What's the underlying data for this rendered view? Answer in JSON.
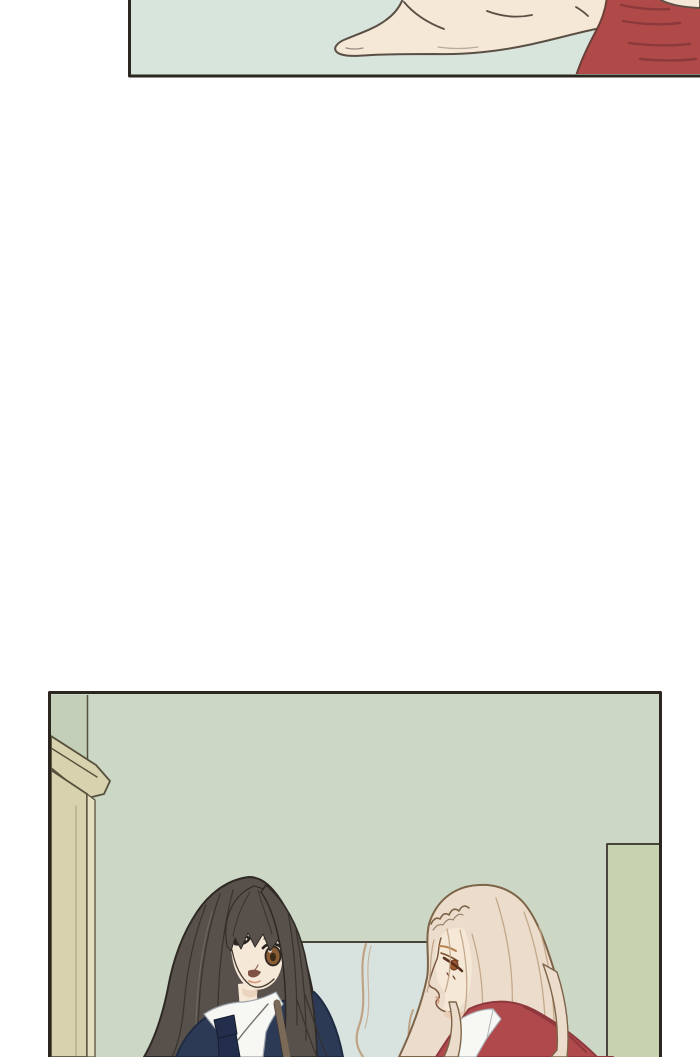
{
  "page": {
    "title": "webtoon comic page",
    "background": "#ffffff",
    "text_content": "none - image-only comic panels"
  },
  "colors": {
    "pageBg": "#ffffff",
    "panelBorder": "#2c2621",
    "mint": "#d8e5dc",
    "skin": "#f5e8d7",
    "outline": "#5a4f44",
    "sleeveRed": "#b04a49",
    "sleeveStroke": "#8c393b",
    "sleeveEdge": "#6b4038",
    "wallGreen": "#ccd8c5",
    "wallStrip": "#c3cfb8",
    "doorKhaki": "#d8d3ae",
    "doorLight": "#e3dfc0",
    "doorLine": "#57503c",
    "cabinetGreen": "#c6d2b0",
    "lowerWallBlue": "#d8e2de",
    "lineDark": "#4a453c",
    "darkHair": "#57504b",
    "darkHairStroke": "#36302b",
    "darkHairLight": "#827a74",
    "faceOutline": "#463a2f",
    "navy": "#2d3a56",
    "navyDark": "#1f2b42",
    "tieNavy": "#222e4c",
    "collarWhite": "#f7f8f4",
    "collarShade": "#9aa1a9",
    "blondeHair": "#ecdccb",
    "blondeStroke": "#c0a384",
    "blondeOutline": "#7d6449",
    "redJacket": "#b0494c",
    "redShadow": "#8e383e",
    "strapBrown": "#7b6a58",
    "irisBrown": "#8a5c34",
    "blondeIris": "#a35a30",
    "blush": "#e9cdb6",
    "lipDark": "#7e5244",
    "lipLight": "#d69478"
  },
  "panels": [
    {
      "name": "panel-1",
      "description": "Close-up of an outstretched open hand reaching to the left over a pale mint background; a dark-red sleeve cuff enters from the right edge. Panel is cropped by the top edge of the page.",
      "left": 128,
      "top": 0,
      "width": 572,
      "height": 78
    },
    {
      "name": "panel-2",
      "description": "Interior with sage-green walls: a long dark-haired girl in a navy school blazer with white collar and dark tie at left looks toward a girl with long wavy pale-blonde hair in a red jacket seen in profile at right; tan door frame at far left, green cabinet at right, pale blue lower wall between them. Panel is cropped by the bottom edge of the page.",
      "left": 48,
      "top": 692,
      "width": 614,
      "height": 365
    }
  ]
}
